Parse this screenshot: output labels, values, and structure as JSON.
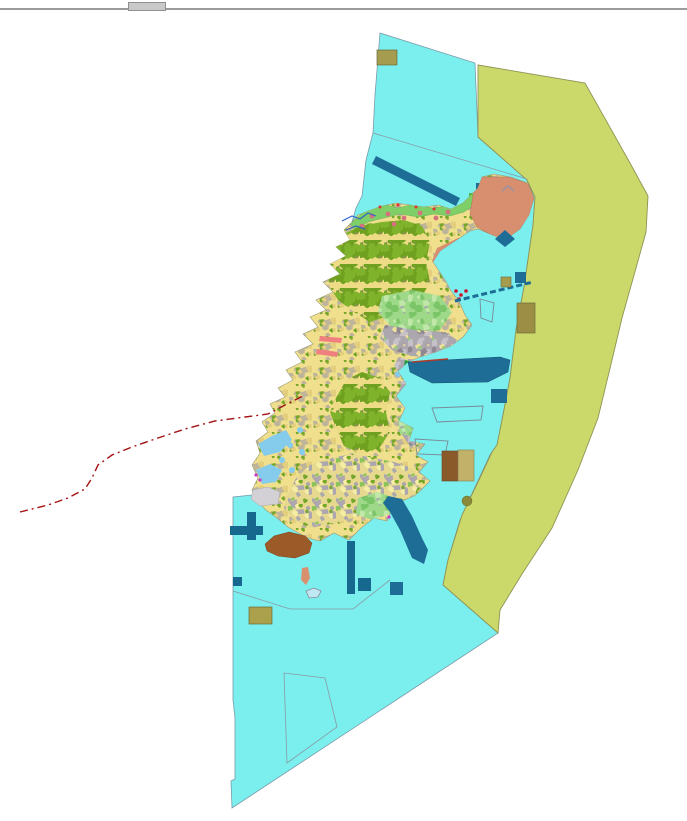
{
  "screen": {
    "width": 687,
    "height": 821,
    "background": "#FFFFFF"
  },
  "chrome": {
    "top_line": {
      "y": 8,
      "height": 2,
      "color": "#9B9B9B"
    },
    "notch": {
      "x": 128,
      "y": 2,
      "width": 36,
      "height": 7,
      "color": "#C9C9C9",
      "border": "#8F8F8F"
    }
  },
  "legend_colors": {
    "open_water": "#7BEEEE",
    "outer_zone": "#CBD96B",
    "agricultural_land": "#F0DF8C",
    "forest": "#6FA01F",
    "urban": "#ACA6AE",
    "reclaimed_salmon": "#D78F70",
    "coastal_green": "#7FCF68",
    "harbor_blue": "#1E6D96",
    "pier_teal": "#16688E",
    "sediment_brown": "#9C5A28",
    "facility_khaki": "#A59C4F",
    "boundary_red_dashed": "#A31111"
  },
  "map": {
    "width": 687,
    "height": 821,
    "patterns": [
      {
        "id": "mosaicYellow",
        "seed": 11,
        "size": 24,
        "bg": "#F0DF8C",
        "shapes": [
          {
            "c": "#74A62A",
            "n": 7,
            "min": 1.5,
            "max": 4
          },
          {
            "c": "#BDB49B",
            "n": 6,
            "min": 1.5,
            "max": 4
          },
          {
            "c": "#E2CE7C",
            "n": 4,
            "min": 2,
            "max": 5
          }
        ]
      },
      {
        "id": "mosaicGreen",
        "seed": 22,
        "size": 24,
        "bg": "#EDDC85",
        "shapes": [
          {
            "c": "#6FA01F",
            "n": 10,
            "min": 3.5,
            "max": 8
          },
          {
            "c": "#7FB32B",
            "n": 6,
            "min": 3,
            "max": 6
          },
          {
            "c": "#8C8C5A",
            "n": 3,
            "min": 0.8,
            "max": 1.6
          }
        ]
      },
      {
        "id": "mosaicGray",
        "seed": 33,
        "size": 24,
        "bg": "#ACA6AE",
        "shapes": [
          {
            "c": "#C6C1C9",
            "n": 7,
            "min": 2,
            "max": 5
          },
          {
            "c": "#8F8893",
            "n": 5,
            "min": 1.5,
            "max": 4
          },
          {
            "c": "#EFE19B",
            "n": 7,
            "min": 1.2,
            "max": 3.2
          },
          {
            "c": "#9DC87E",
            "n": 2,
            "min": 1.2,
            "max": 2.5
          }
        ]
      },
      {
        "id": "mosaicMixed",
        "seed": 44,
        "size": 24,
        "bg": "#E6D98F",
        "shapes": [
          {
            "c": "#ACA6AE",
            "n": 8,
            "min": 2,
            "max": 5
          },
          {
            "c": "#8CC45A",
            "n": 4,
            "min": 1.5,
            "max": 3.5
          },
          {
            "c": "#F5EDA6",
            "n": 4,
            "min": 2,
            "max": 4
          },
          {
            "c": "#74A62A",
            "n": 3,
            "min": 1.2,
            "max": 3
          }
        ]
      },
      {
        "id": "mosaicLightGreen",
        "seed": 55,
        "size": 24,
        "bg": "#9ED98A",
        "shapes": [
          {
            "c": "#7CC468",
            "n": 6,
            "min": 2,
            "max": 5.5
          },
          {
            "c": "#C0E8A8",
            "n": 5,
            "min": 2,
            "max": 4.5
          },
          {
            "c": "#ACA6AE",
            "n": 3,
            "min": 1,
            "max": 2.5
          }
        ]
      }
    ],
    "features": [
      {
        "name": "water-polygon",
        "shape": "polygon",
        "fill": "#7BEEEE",
        "stroke": "#7A9BAA",
        "sw": 0.8,
        "points": "380,33 475,63 478,137 527,180 535,197 533,225 524,287 516,330 510,378 503,415 497,445 490,455 475,487 460,520 448,560 443,585 498,633 232,808 231,781 235,779 235,718 233,700 233,497 252,495 262,478 268,460 275,440 288,415 300,390 312,362 318,338 330,312 342,286 350,262 355,240 352,222 356,208 362,196 366,160 373,133 375,95"
      },
      {
        "name": "outer-zone-polygon",
        "shape": "polygon",
        "fill": "#CBD96B",
        "stroke": "#8E9353",
        "sw": 0.9,
        "points": "478,65 585,83 630,163 648,196 646,232 636,268 622,318 612,360 598,418 578,470 552,528 522,574 500,610 498,633 443,585 448,560 462,515 478,482 492,452 497,445 503,415 510,378 516,330 524,287 533,225 535,197 527,180 478,137"
      },
      {
        "name": "parcel-boundary-upper",
        "shape": "line",
        "x1": 373,
        "y1": 133,
        "x2": 527,
        "y2": 179,
        "stroke": "#8A9AA5",
        "sw": 0.8
      },
      {
        "name": "parcel-boundary-south",
        "shape": "polyline",
        "points": "233,591 290,609 353,609 390,580",
        "stroke": "#8A9AA5",
        "sw": 0.8
      },
      {
        "name": "parcel-outline-bottom",
        "shape": "polygon",
        "fill": "none",
        "stroke": "#8A9AA5",
        "sw": 0.8,
        "points": "284,673 325,678 337,727 287,763"
      },
      {
        "name": "ne-harbor-band",
        "shape": "line",
        "x1": 374,
        "y1": 160,
        "x2": 458,
        "y2": 202,
        "stroke": "#1E6D96",
        "sw": 9
      },
      {
        "name": "khaki-square-north",
        "shape": "rect",
        "x": 377,
        "y": 50,
        "w": 20,
        "h": 15,
        "fill": "#A59C4F",
        "stroke": "#6B6B3A",
        "sw": 0.7
      },
      {
        "name": "ne-blue-square",
        "shape": "rect",
        "x": 476,
        "y": 183,
        "w": 13,
        "h": 13,
        "fill": "#1E6D96"
      },
      {
        "name": "ne-green-rect",
        "shape": "rect",
        "x": 469,
        "y": 193,
        "w": 24,
        "h": 10,
        "fill": "#4CB648"
      },
      {
        "name": "island-base",
        "shape": "polygon",
        "fill": "pattern:mosaicYellow",
        "stroke": "#9A9A78",
        "sw": 0.6,
        "points": "352,222 344,230 350,240 336,247 346,256 330,264 340,274 323,282 333,292 316,300 326,310 310,317 318,327 303,334 313,344 295,352 302,362 286,370 293,380 278,388 285,397 270,404 275,413 262,422 268,432 256,441 260,453 252,465 258,478 252,490 256,500 266,510 277,518 288,527 295,531 308,538 320,541 334,533 349,540 361,528 374,518 387,521 392,509 402,501 414,496 421,490 430,481 419,472 428,462 416,455 425,444 409,441 413,428 399,421 405,408 396,396 406,384 398,371 408,362 420,357 436,352 451,346 463,337 472,325 465,315 459,301 451,291 445,280 437,268 433,262 440,251 455,241 470,231 478,229 490,234 505,240 520,229 529,215 534,198 528,183 510,177 494,174 482,177 478,188 470,196 463,203 451,209 438,205 424,207 410,205 396,203 382,206 368,211 358,215"
      },
      {
        "name": "coastal-strip-north",
        "shape": "polygon",
        "clip": true,
        "fill": "#7FCF68",
        "stroke": "#5FA84E",
        "sw": 0.4,
        "points": "350,224 366,210 382,204 398,208 414,204 432,208 448,206 462,200 472,194 476,204 464,212 450,216 434,214 418,217 400,214 384,218 368,222 356,230"
      },
      {
        "name": "forest-region-nw",
        "shape": "polygon",
        "clip": true,
        "fill": "pattern:mosaicGreen",
        "points": "322,252 340,236 360,226 382,222 404,220 422,226 430,242 426,262 430,282 420,300 424,316 406,322 388,316 370,322 354,312 338,300 328,284 332,266"
      },
      {
        "name": "lightgreen-region-mid",
        "shape": "polygon",
        "clip": true,
        "fill": "pattern:mosaicLightGreen",
        "points": "382,296 412,290 440,296 452,312 440,330 414,334 392,328 378,312"
      },
      {
        "name": "urban-region-central",
        "shape": "polygon",
        "clip": true,
        "fill": "pattern:mosaicGray",
        "points": "385,325 415,330 445,332 460,342 455,355 435,358 412,356 392,350 380,338"
      },
      {
        "name": "urban-region-east",
        "shape": "polygon",
        "clip": true,
        "fill": "pattern:mosaicGray",
        "points": "398,358 420,360 440,358 452,368 444,386 448,406 436,420 440,436 424,444 410,446 400,432 406,412 398,394 404,376 394,366"
      },
      {
        "name": "mixed-region-south",
        "shape": "polygon",
        "clip": true,
        "fill": "pattern:mosaicMixed",
        "points": "286,498 296,478 310,465 330,458 352,454 374,458 394,462 412,468 422,480 414,494 396,504 374,510 352,518 330,524 310,528 294,520 284,508"
      },
      {
        "name": "forest-region-central",
        "shape": "polygon",
        "clip": true,
        "fill": "pattern:mosaicGreen",
        "points": "336,398 346,380 362,372 380,378 390,392 386,412 390,432 378,450 360,454 344,446 336,428 330,412"
      },
      {
        "name": "lightgreen-patch-south",
        "shape": "polygon",
        "clip": true,
        "fill": "pattern:mosaicLightGreen",
        "points": "358,498 378,492 394,498 390,514 372,520 356,514"
      },
      {
        "name": "lightgreen-patch-se",
        "shape": "polygon",
        "clip": true,
        "fill": "pattern:mosaicLightGreen",
        "points": "398,418 412,414 420,424 414,436 400,434"
      },
      {
        "name": "salmon-region-ne",
        "shape": "polygon",
        "clip": true,
        "fill": "#D78F70",
        "stroke": "#B5714F",
        "sw": 0.5,
        "points": "478,177 510,177 528,184 534,198 529,217 519,230 505,240 490,234 477,227 470,214 473,196"
      },
      {
        "name": "salmon-band-ne",
        "shape": "polygon",
        "clip": true,
        "fill": "#D78F70",
        "points": "437,248 458,238 482,232 503,237 501,253 480,259 458,267 442,272 432,261"
      },
      {
        "name": "gray-chevron-mark",
        "shape": "polyline",
        "points": "502,191 508,186 514,191",
        "stroke": "#9A93A2",
        "sw": 1.5
      },
      {
        "name": "darkgreen-coast-blob",
        "shape": "polygon",
        "clip": true,
        "fill": "#1F9E3C",
        "points": "405,360 413,362 415,374 409,379 403,372"
      },
      {
        "name": "lagoon-patch-west-1",
        "shape": "polygon",
        "clip": true,
        "fill": "#85CBEC",
        "points": "258,444 272,436 286,430 292,440 280,452 264,456"
      },
      {
        "name": "lagoon-patch-west-2",
        "shape": "polygon",
        "clip": true,
        "fill": "#85CBEC",
        "points": "256,470 270,464 282,470 276,482 262,484"
      },
      {
        "name": "lagoon-dots-west",
        "shape": "dots",
        "clip": true,
        "fill": "#85CBEC",
        "r": 3,
        "pts": [
          [
            300,
            430
          ],
          [
            290,
            445
          ],
          [
            282,
            460
          ],
          [
            292,
            470
          ],
          [
            302,
            452
          ],
          [
            398,
            374
          ],
          [
            430,
            426
          ],
          [
            426,
            440
          ]
        ]
      },
      {
        "name": "tidal-flat-gray",
        "shape": "polygon",
        "fill": "#D3D0D6",
        "stroke": "#AAAAB0",
        "sw": 0.5,
        "points": "253,490 268,487 280,492 278,504 260,506 251,499"
      },
      {
        "name": "rose-strip-west-1",
        "shape": "polygon",
        "fill": "#F08080",
        "points": "320,336 342,338 341,343 319,341"
      },
      {
        "name": "rose-strip-west-2",
        "shape": "polygon",
        "fill": "#F08080",
        "points": "317,349 338,352 337,357 316,354"
      },
      {
        "name": "salmon-dots-northcoast",
        "shape": "dots",
        "clip": true,
        "fill": "#D4717D",
        "r": 2.4,
        "pts": [
          [
            372,
            216
          ],
          [
            388,
            214
          ],
          [
            404,
            218
          ],
          [
            420,
            213
          ],
          [
            436,
            218
          ],
          [
            448,
            212
          ],
          [
            362,
            226
          ],
          [
            394,
            224
          ]
        ]
      },
      {
        "name": "red-ticks-northcoast",
        "shape": "dots",
        "fill": "#E23030",
        "r": 1.5,
        "pts": [
          [
            380,
            207
          ],
          [
            398,
            205
          ],
          [
            416,
            207
          ],
          [
            434,
            209
          ]
        ]
      },
      {
        "name": "red-cluster-eastcoast",
        "shape": "dots",
        "fill": "#CC1030",
        "r": 1.8,
        "pts": [
          [
            456,
            291
          ],
          [
            461,
            295
          ],
          [
            466,
            291
          ],
          [
            459,
            299
          ]
        ]
      },
      {
        "name": "magenta-dots",
        "shape": "dots",
        "fill": "#C838C8",
        "r": 1.6,
        "pts": [
          [
            392,
            505
          ],
          [
            397,
            513
          ],
          [
            389,
            517
          ],
          [
            256,
            475
          ],
          [
            260,
            480
          ]
        ]
      },
      {
        "name": "stream-north-1",
        "shape": "polyline",
        "points": "342,221 352,216 360,219 368,213 376,216",
        "stroke": "#2F62C8",
        "sw": 1.2
      },
      {
        "name": "stream-north-2",
        "shape": "polyline",
        "points": "346,230 356,226 365,229",
        "stroke": "#2F62C8",
        "sw": 1.2
      },
      {
        "name": "ne-blue-diamond",
        "shape": "polygon",
        "fill": "#1E6D96",
        "points": "495,239 505,230 515,239 505,247"
      },
      {
        "name": "harbor-band-se",
        "shape": "polygon",
        "fill": "#1E6D96",
        "stroke": "#14516F",
        "sw": 0.5,
        "points": "408,362 500,357 510,360 508,372 488,382 432,383 410,372"
      },
      {
        "name": "harbor-band-red-edge",
        "shape": "line",
        "x1": 412,
        "y1": 362,
        "x2": 448,
        "y2": 359,
        "stroke": "#B03A2A",
        "sw": 1.4
      },
      {
        "name": "causeway-dashed",
        "shape": "line",
        "x1": 455,
        "y1": 301,
        "x2": 533,
        "y2": 282,
        "stroke": "#1E6D96",
        "sw": 3,
        "dash": "6,3"
      },
      {
        "name": "outlined-quad-east",
        "shape": "polygon",
        "fill": "none",
        "stroke": "#7A8A99",
        "sw": 0.9,
        "points": "432,408 483,406 481,420 437,422"
      },
      {
        "name": "outlined-quad-east-2",
        "shape": "polygon",
        "fill": "none",
        "stroke": "#7A8A99",
        "sw": 0.9,
        "points": "415,439 448,441 445,455 417,454"
      },
      {
        "name": "outlined-pentagon-east",
        "shape": "polygon",
        "fill": "none",
        "stroke": "#7A8A99",
        "sw": 0.9,
        "points": "480,299 494,303 492,322 481,318"
      },
      {
        "name": "khaki-square-ne-small",
        "shape": "rect",
        "x": 501,
        "y": 277,
        "w": 10,
        "h": 10,
        "fill": "#A59C4F",
        "stroke": "#6B6B3A",
        "sw": 0.6
      },
      {
        "name": "blue-square-ne-small",
        "shape": "rect",
        "x": 515,
        "y": 272,
        "w": 11,
        "h": 11,
        "fill": "#1E6D96"
      },
      {
        "name": "khaki-rect-zone-edge",
        "shape": "rect",
        "x": 517,
        "y": 303,
        "w": 18,
        "h": 30,
        "fill": "#9C8F45",
        "stroke": "#6B6B3A",
        "sw": 0.7
      },
      {
        "name": "blue-square-se",
        "shape": "rect",
        "x": 491,
        "y": 389,
        "w": 16,
        "h": 14,
        "fill": "#1E6D96"
      },
      {
        "name": "diagonal-band-se",
        "shape": "polygon",
        "fill": "#1E6D96",
        "points": "388,496 402,499 412,516 422,538 428,550 424,564 412,558 400,530 390,512 383,503"
      },
      {
        "name": "brown-rect-offshore",
        "shape": "rect",
        "x": 442,
        "y": 451,
        "w": 16,
        "h": 30,
        "fill": "#8B5A2B",
        "stroke": "#6B4420",
        "sw": 0.6
      },
      {
        "name": "khaki-rect-offshore",
        "shape": "rect",
        "x": 458,
        "y": 450,
        "w": 16,
        "h": 31,
        "fill": "#C2B169",
        "stroke": "#8A8050",
        "sw": 0.6
      },
      {
        "name": "olive-dot-offshore",
        "shape": "ellipse",
        "cx": 467,
        "cy": 501,
        "rx": 5,
        "ry": 5,
        "fill": "#8A8A3A",
        "stroke": "#6B6B2A",
        "sw": 0.5
      },
      {
        "name": "pier-horizontal-sw",
        "shape": "rect",
        "x": 230,
        "y": 526,
        "w": 33,
        "h": 9,
        "fill": "#16688E"
      },
      {
        "name": "pier-vertical-sw",
        "shape": "rect",
        "x": 247,
        "y": 512,
        "w": 9,
        "h": 28,
        "fill": "#16688E"
      },
      {
        "name": "teal-square-sw-edge",
        "shape": "rect",
        "x": 233,
        "y": 577,
        "w": 9,
        "h": 9,
        "fill": "#16688E"
      },
      {
        "name": "sediment-blob-brown",
        "shape": "polygon",
        "fill": "#9C5A28",
        "stroke": "#7A4118",
        "sw": 0.5,
        "points": "265,544 274,536 289,532 305,536 312,543 309,553 295,558 278,556 267,551"
      },
      {
        "name": "salmon-islet-south",
        "shape": "polygon",
        "fill": "#D9906E",
        "points": "302,568 308,567 310,578 306,585 301,580"
      },
      {
        "name": "outlined-islet-south",
        "shape": "polygon",
        "fill": "#BFE8F2",
        "stroke": "#8A8A99",
        "sw": 0.8,
        "points": "306,591 314,588 321,591 318,597 309,598"
      },
      {
        "name": "teal-bar-south",
        "shape": "rect",
        "x": 347,
        "y": 541,
        "w": 8,
        "h": 53,
        "fill": "#16688E"
      },
      {
        "name": "teal-square-south-1",
        "shape": "rect",
        "x": 358,
        "y": 578,
        "w": 13,
        "h": 13,
        "fill": "#16688E"
      },
      {
        "name": "teal-square-south-2",
        "shape": "rect",
        "x": 390,
        "y": 582,
        "w": 13,
        "h": 13,
        "fill": "#1E6D96"
      },
      {
        "name": "khaki-rect-bottom",
        "shape": "rect",
        "x": 249,
        "y": 607,
        "w": 23,
        "h": 17,
        "fill": "#ABA04C",
        "stroke": "#6B6B3A",
        "sw": 0.7
      },
      {
        "name": "red-dashed-boundary",
        "shape": "polyline",
        "stroke": "#A31111",
        "sw": 1.4,
        "dash": "8,4,2,4",
        "points": "20,512 48,505 68,498 85,489 92,478 98,465 112,455 132,447 158,438 185,429 215,421 245,417 268,414 285,405 303,396"
      }
    ]
  }
}
